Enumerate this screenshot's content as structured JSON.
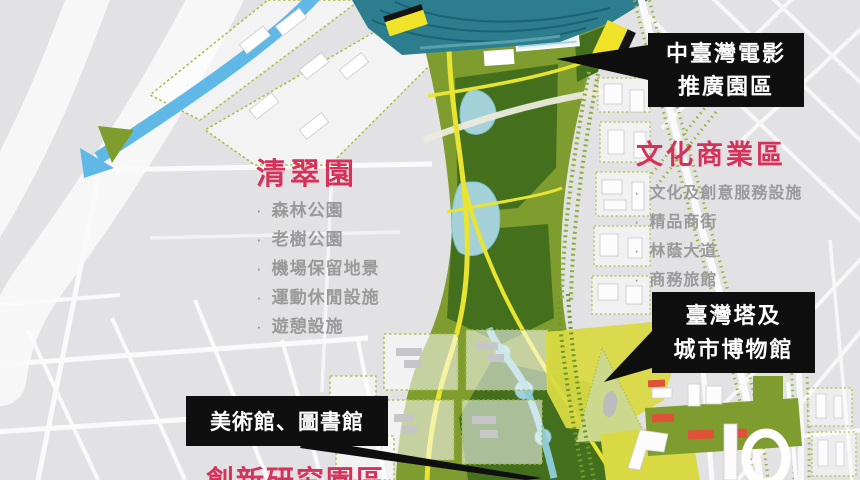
{
  "canvas": {
    "width": 860,
    "height": 480
  },
  "labels": {
    "film_park": {
      "line1": "中臺灣電影",
      "line2": "推廣園區"
    },
    "cultural_commercial": {
      "title": "文化商業區",
      "items": [
        "文化及創意服務設施",
        "精品商街",
        "林蔭大道",
        "商務旅館"
      ]
    },
    "qingcui_park": {
      "title": "清翠園",
      "items": [
        "森林公園",
        "老樹公園",
        "機場保留地景",
        "運動休閒設施",
        "遊憩設施"
      ]
    },
    "taiwan_tower": {
      "line1": "臺灣塔及",
      "line2": "城市博物館"
    },
    "museum_library": {
      "label": "美術館、圖書館"
    },
    "innovation_park": {
      "title": "創新研究園區"
    }
  },
  "colors": {
    "background": "#e2e2e4",
    "park_olive": "#7f9c2e",
    "park_dark_green": "#44701e",
    "stadium_teal": "#2c7e8f",
    "lake_teal": "#a4d2d8",
    "river_blue": "#5fb8e6",
    "road_yellow": "#e8e431",
    "zone_yellow": "#d9d943",
    "marker_yellow": "#f0e32a",
    "building_red": "#e05238",
    "callout_background": "#0f0f0f",
    "callout_text": "#ffffff",
    "district_title_red": "#d6315a",
    "list_item_gray": "#999999"
  }
}
